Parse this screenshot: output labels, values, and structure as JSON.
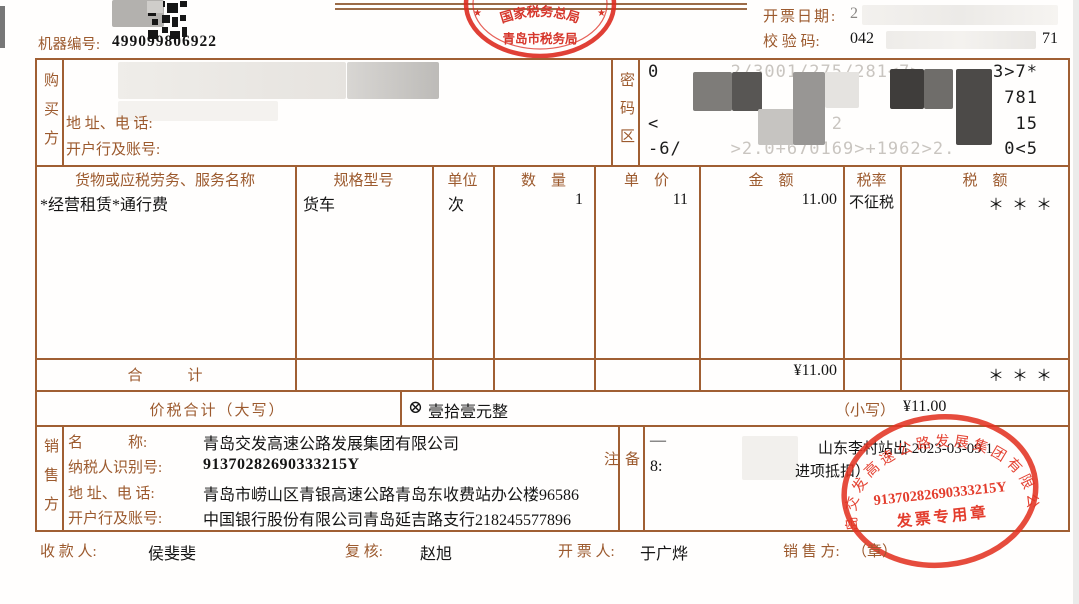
{
  "header": {
    "machine_no_label": "机器编号:",
    "machine_no": "499099806922",
    "invoice_date_label": "开票日期:",
    "invoice_date_partial": "2",
    "check_code_label": "校 验 码:",
    "check_code_start": "042",
    "check_code_end": "71",
    "tax_bureau_stamp": {
      "line1": "国家税务总局",
      "line2": "青岛市税务局",
      "star": "★"
    }
  },
  "buyer": {
    "section_label": "购买方",
    "address_label": "地 址、电 话:",
    "bank_label": "开户行及账号:"
  },
  "password_area": {
    "label": "密码区",
    "line1_start": "0",
    "line1_mid": "2/3001/275/281<7>",
    "line1_end": "3>7*",
    "line2_end": "781",
    "line3_start": "<",
    "line3_mid": "2",
    "line3_end": "15",
    "line4_start": "-6/",
    "line4_mid": ">2.0+670169>+1962>2.",
    "line4_end": "0<5"
  },
  "items_table": {
    "col_name": "货物或应税劳务、服务名称",
    "col_spec": "规格型号",
    "col_unit": "单位",
    "col_qty": "数　量",
    "col_price": "单　价",
    "col_amount": "金　额",
    "col_tax_rate": "税率",
    "col_tax": "税　额",
    "item": {
      "name": "*经营租赁*通行费",
      "spec": "货车",
      "unit": "次",
      "qty": "1",
      "price": "11",
      "amount": "11.00",
      "tax_rate": "不征税",
      "tax": "＊ ＊ ＊"
    },
    "total_label": "合　　　计",
    "total_amount": "¥11.00",
    "total_tax": "＊ ＊ ＊"
  },
  "sum_row": {
    "label": "价税合计（大写）",
    "symbol": "⊗",
    "words": "壹拾壹元整",
    "small_label": "（小写）",
    "small_value": "¥11.00"
  },
  "seller": {
    "section_label": "销售方",
    "name_label": "名　　　称:",
    "name": "青岛交发高速公路发展集团有限公司",
    "tax_id_label": "纳税人识别号:",
    "tax_id": "91370282690333215Y",
    "address_label": "地 址、电 话:",
    "address": "青岛市崂山区青银高速公路青岛东收费站办公楼96586",
    "bank_label": "开户行及账号:",
    "bank": "中国银行股份有限公司青岛延吉路支行218245577896"
  },
  "remark": {
    "label": "备注",
    "dash": "—",
    "line1": "山东李村站出 2023-03-09 1",
    "line2_start": "8:",
    "line2_end": "进项抵扣）"
  },
  "seller_stamp": {
    "company": "青岛交发高速公路发展集团有限公司",
    "tax_id": "91370282690333215Y",
    "title": "发票专用章"
  },
  "footer": {
    "payee_label": "收 款 人:",
    "payee": "侯斐斐",
    "reviewer_label": "复  核:",
    "reviewer": "赵旭",
    "drawer_label": "开 票 人:",
    "drawer": "于广烨",
    "seller_label": "销 售 方:",
    "seller_seal": "（章）"
  },
  "colors": {
    "border": "#a05f33",
    "label": "#9c5a2e",
    "stamp_red": "#e03224",
    "text": "#1a1a1a"
  }
}
